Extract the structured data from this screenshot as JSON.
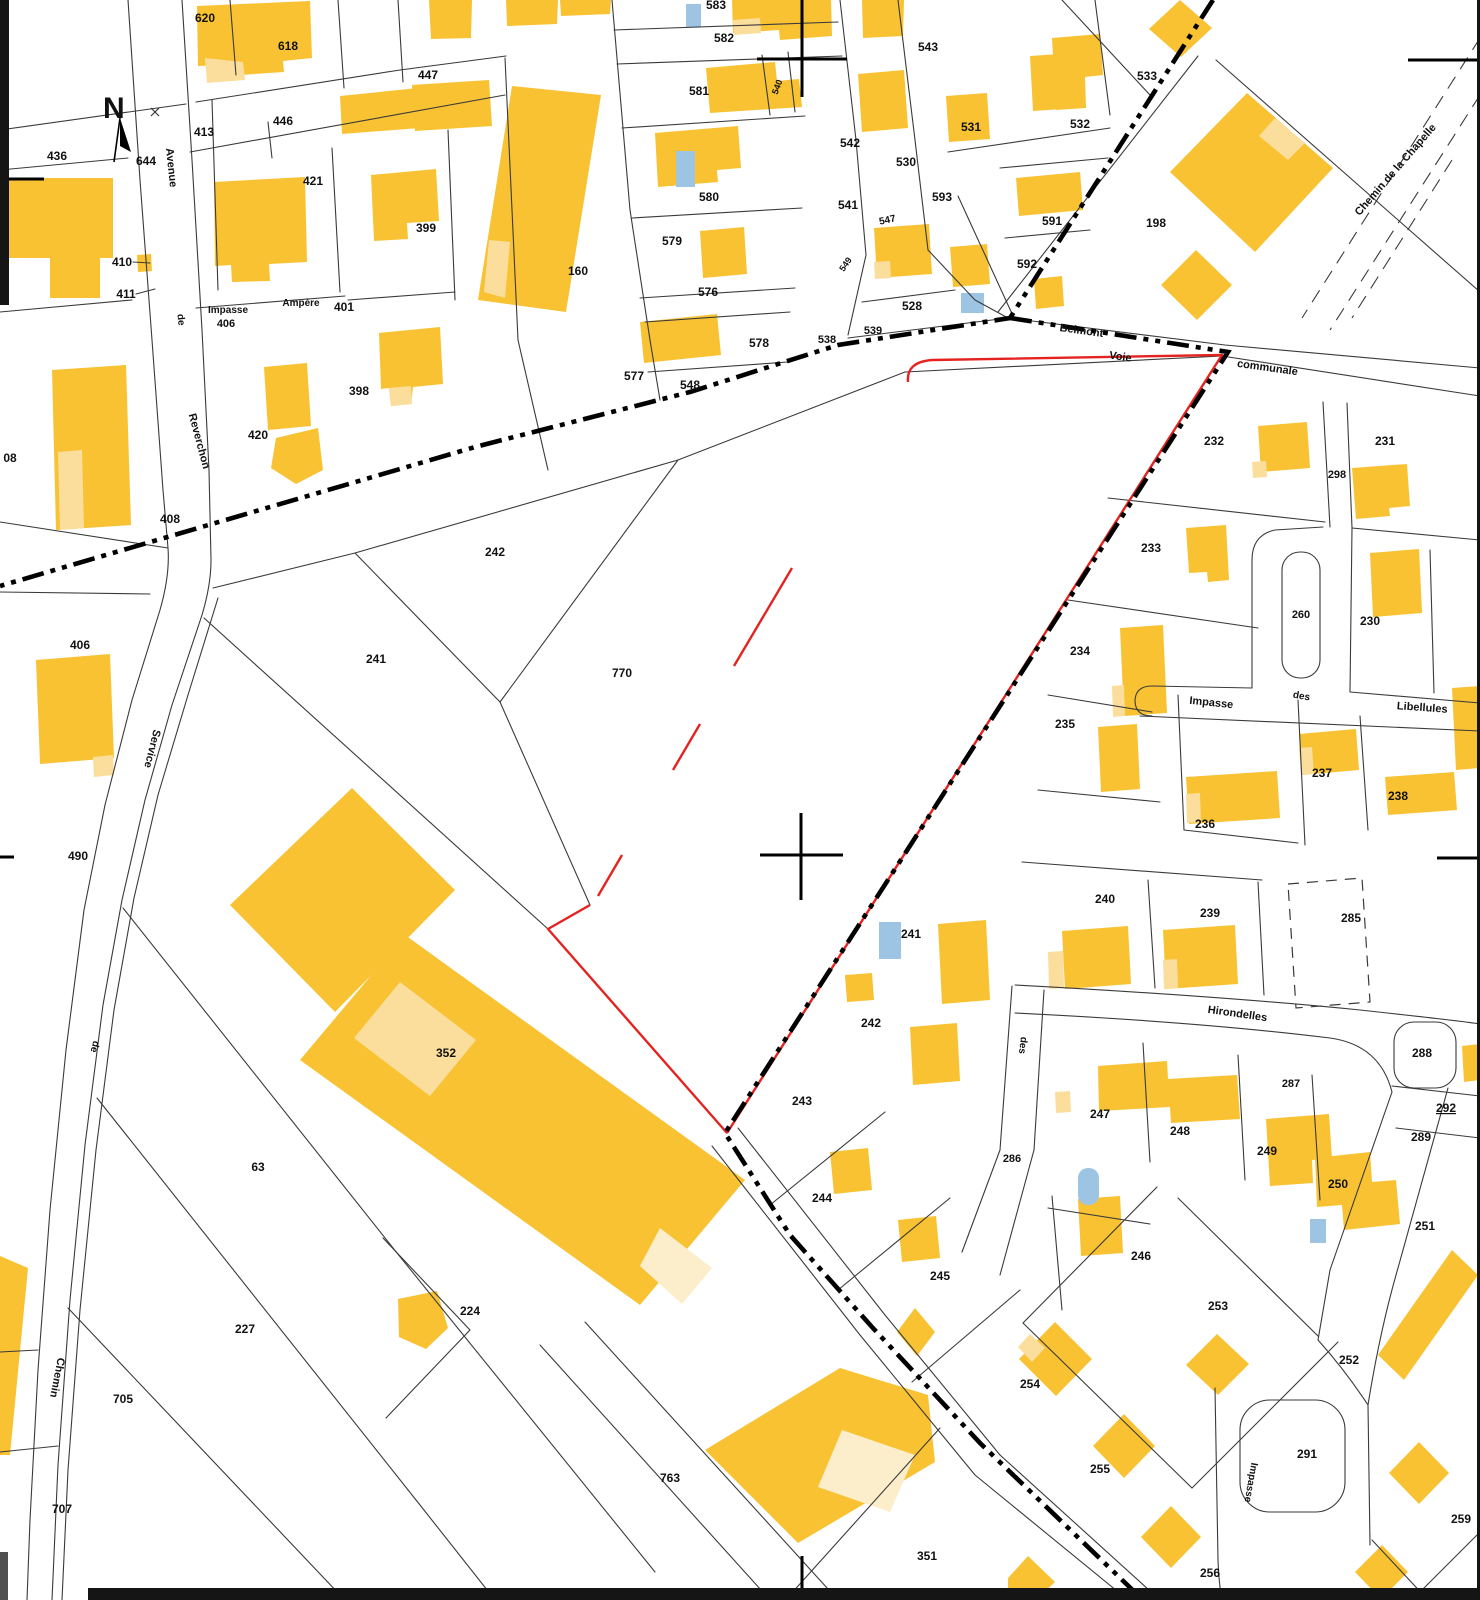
{
  "map": {
    "kind": "cadastral-plan",
    "north_marker": "N",
    "colors": {
      "building": "#F8C232",
      "building_light": "#FBDE9C",
      "pool": "#9EC4E3",
      "parcel_line": "#3a3a3a",
      "commune_boundary": "#000000",
      "selected_parcel_outline": "#E42320",
      "background": "#ffffff",
      "label": "#111111"
    },
    "parcel_labels": [
      {
        "t": "620",
        "x": 205,
        "y": 22
      },
      {
        "t": "618",
        "x": 288,
        "y": 50
      },
      {
        "t": "583",
        "x": 716,
        "y": 9
      },
      {
        "t": "582",
        "x": 724,
        "y": 42
      },
      {
        "t": "447",
        "x": 428,
        "y": 79
      },
      {
        "t": "543",
        "x": 928,
        "y": 51
      },
      {
        "t": "533",
        "x": 1147,
        "y": 80
      },
      {
        "t": "446",
        "x": 283,
        "y": 125
      },
      {
        "t": "413",
        "x": 204,
        "y": 136
      },
      {
        "t": "532",
        "x": 1080,
        "y": 128
      },
      {
        "t": "531",
        "x": 971,
        "y": 131
      },
      {
        "t": "436",
        "x": 57,
        "y": 160
      },
      {
        "t": "644",
        "x": 146,
        "y": 165
      },
      {
        "t": "581",
        "x": 699,
        "y": 95
      },
      {
        "t": "542",
        "x": 850,
        "y": 147
      },
      {
        "t": "530",
        "x": 906,
        "y": 166
      },
      {
        "t": "421",
        "x": 313,
        "y": 185
      },
      {
        "t": "399",
        "x": 426,
        "y": 232
      },
      {
        "t": "198",
        "x": 1156,
        "y": 227
      },
      {
        "t": "580",
        "x": 709,
        "y": 201
      },
      {
        "t": "541",
        "x": 848,
        "y": 209
      },
      {
        "t": "593",
        "x": 942,
        "y": 201
      },
      {
        "t": "591",
        "x": 1052,
        "y": 225
      },
      {
        "t": "410",
        "x": 122,
        "y": 266
      },
      {
        "t": "411",
        "x": 126,
        "y": 298
      },
      {
        "t": "579",
        "x": 672,
        "y": 245
      },
      {
        "t": "592",
        "x": 1027,
        "y": 268
      },
      {
        "t": "160",
        "x": 578,
        "y": 275
      },
      {
        "t": "576",
        "x": 708,
        "y": 296
      },
      {
        "t": "406",
        "x": 226,
        "y": 327,
        "s": 11
      },
      {
        "t": "401",
        "x": 344,
        "y": 311
      },
      {
        "t": "578",
        "x": 759,
        "y": 347
      },
      {
        "t": "528",
        "x": 912,
        "y": 310
      },
      {
        "t": "538",
        "x": 827,
        "y": 343,
        "s": 11
      },
      {
        "t": "539",
        "x": 873,
        "y": 334,
        "s": 11
      },
      {
        "t": "577",
        "x": 634,
        "y": 380
      },
      {
        "t": "548",
        "x": 690,
        "y": 389
      },
      {
        "t": "398",
        "x": 359,
        "y": 395
      },
      {
        "t": "420",
        "x": 258,
        "y": 439
      },
      {
        "t": "232",
        "x": 1214,
        "y": 445
      },
      {
        "t": "231",
        "x": 1385,
        "y": 445
      },
      {
        "t": "298",
        "x": 1337,
        "y": 478,
        "s": 11
      },
      {
        "t": "408",
        "x": 170,
        "y": 523
      },
      {
        "t": "242",
        "x": 495,
        "y": 556
      },
      {
        "t": "233",
        "x": 1151,
        "y": 552
      },
      {
        "t": "230",
        "x": 1370,
        "y": 625
      },
      {
        "t": "260",
        "x": 1301,
        "y": 618,
        "s": 11
      },
      {
        "t": "234",
        "x": 1080,
        "y": 655
      },
      {
        "t": "235",
        "x": 1065,
        "y": 728
      },
      {
        "t": "237",
        "x": 1322,
        "y": 777
      },
      {
        "t": "238",
        "x": 1398,
        "y": 800
      },
      {
        "t": "236",
        "x": 1205,
        "y": 828
      },
      {
        "t": "241",
        "x": 376,
        "y": 663
      },
      {
        "t": "770",
        "x": 622,
        "y": 677
      },
      {
        "t": "406",
        "x": 80,
        "y": 649
      },
      {
        "t": "490",
        "x": 78,
        "y": 860
      },
      {
        "t": "242",
        "x": 871,
        "y": 1027
      },
      {
        "t": "241",
        "x": 911,
        "y": 938
      },
      {
        "t": "240",
        "x": 1105,
        "y": 903
      },
      {
        "t": "239",
        "x": 1210,
        "y": 917
      },
      {
        "t": "285",
        "x": 1351,
        "y": 922
      },
      {
        "t": "287",
        "x": 1291,
        "y": 1087,
        "s": 11
      },
      {
        "t": "288",
        "x": 1422,
        "y": 1057
      },
      {
        "t": "292",
        "x": 1446,
        "y": 1112,
        "u": 1
      },
      {
        "t": "289",
        "x": 1421,
        "y": 1141
      },
      {
        "t": "243",
        "x": 802,
        "y": 1105
      },
      {
        "t": "247",
        "x": 1100,
        "y": 1118
      },
      {
        "t": "248",
        "x": 1180,
        "y": 1135
      },
      {
        "t": "286",
        "x": 1012,
        "y": 1162,
        "s": 11
      },
      {
        "t": "249",
        "x": 1267,
        "y": 1155
      },
      {
        "t": "250",
        "x": 1338,
        "y": 1188
      },
      {
        "t": "244",
        "x": 822,
        "y": 1202
      },
      {
        "t": "246",
        "x": 1141,
        "y": 1260
      },
      {
        "t": "251",
        "x": 1425,
        "y": 1230
      },
      {
        "t": "245",
        "x": 940,
        "y": 1280
      },
      {
        "t": "253",
        "x": 1218,
        "y": 1310
      },
      {
        "t": "252",
        "x": 1349,
        "y": 1364
      },
      {
        "t": "254",
        "x": 1030,
        "y": 1388
      },
      {
        "t": "224",
        "x": 470,
        "y": 1315
      },
      {
        "t": "227",
        "x": 245,
        "y": 1333
      },
      {
        "t": "705",
        "x": 123,
        "y": 1403
      },
      {
        "t": "707",
        "x": 62,
        "y": 1513
      },
      {
        "t": "763",
        "x": 670,
        "y": 1482
      },
      {
        "t": "255",
        "x": 1100,
        "y": 1473
      },
      {
        "t": "291",
        "x": 1307,
        "y": 1458
      },
      {
        "t": "256",
        "x": 1210,
        "y": 1577
      },
      {
        "t": "259",
        "x": 1461,
        "y": 1523
      },
      {
        "t": "351",
        "x": 927,
        "y": 1560
      },
      {
        "t": "352",
        "x": 446,
        "y": 1057
      },
      {
        "t": "63",
        "x": 258,
        "y": 1171
      },
      {
        "t": "08",
        "x": 10,
        "y": 462
      },
      {
        "t": "540",
        "x": 780,
        "y": 88,
        "r": -70,
        "s": 9
      },
      {
        "t": "549",
        "x": 848,
        "y": 266,
        "r": -55,
        "s": 9
      },
      {
        "t": "547",
        "x": 888,
        "y": 223,
        "r": -12,
        "s": 10
      }
    ],
    "street_labels": [
      {
        "t": "Avenue",
        "x": 168,
        "y": 168,
        "r": 84
      },
      {
        "t": "de",
        "x": 178,
        "y": 320,
        "r": 84,
        "s": 10
      },
      {
        "t": "Reverchon",
        "x": 196,
        "y": 442,
        "r": 75
      },
      {
        "t": "Service",
        "x": 149,
        "y": 748,
        "r": 104
      },
      {
        "t": "de",
        "x": 92,
        "y": 1046,
        "r": 104,
        "s": 10
      },
      {
        "t": "Chemin",
        "x": 54,
        "y": 1377,
        "r": 101
      },
      {
        "t": "Impasse",
        "x": 228,
        "y": 313,
        "s": 10
      },
      {
        "t": "Ampère",
        "x": 301,
        "y": 306,
        "s": 10
      },
      {
        "t": "Belmont",
        "x": 1081,
        "y": 334,
        "r": 8
      },
      {
        "t": "Voie",
        "x": 1120,
        "y": 360,
        "r": 8
      },
      {
        "t": "communale",
        "x": 1267,
        "y": 371,
        "r": 8
      },
      {
        "t": "Chemin de la Chapelle",
        "x": 1398,
        "y": 172,
        "r": -49
      },
      {
        "t": "Impasse",
        "x": 1211,
        "y": 706,
        "r": 6
      },
      {
        "t": "des",
        "x": 1301,
        "y": 699,
        "r": 10,
        "s": 10
      },
      {
        "t": "Libellules",
        "x": 1422,
        "y": 711,
        "r": 4
      },
      {
        "t": "Hirondelles",
        "x": 1237,
        "y": 1017,
        "r": 8
      },
      {
        "t": "des",
        "x": 1020,
        "y": 1045,
        "r": 97,
        "s": 10
      },
      {
        "t": "Impasse",
        "x": 1248,
        "y": 1482,
        "r": 100,
        "s": 10
      }
    ]
  }
}
